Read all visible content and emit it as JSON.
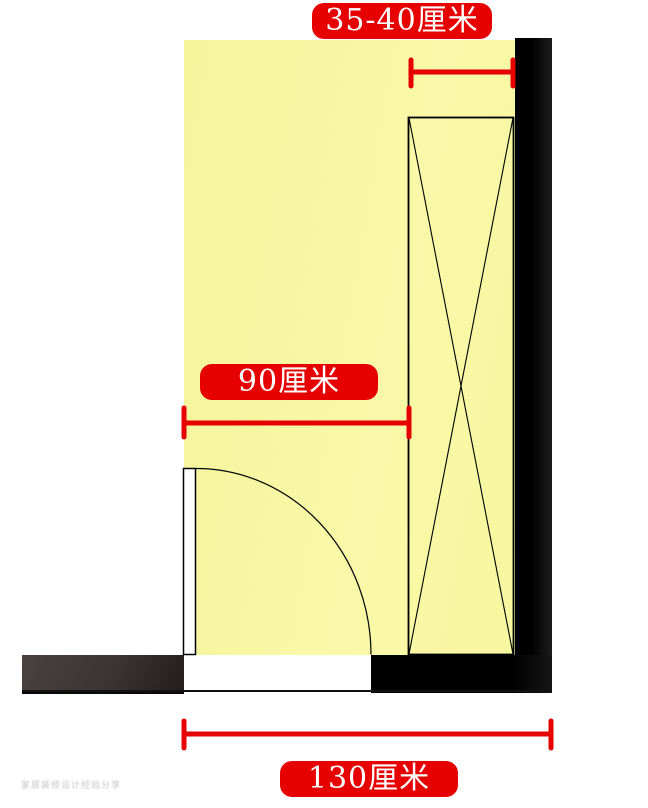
{
  "diagram": {
    "type": "floor-plan",
    "unit": "厘米",
    "dimension_labels": {
      "wardrobe_depth": "35-40厘米",
      "door_to_wardrobe": "90厘米",
      "total_width": "130厘米"
    },
    "dimensions": [
      {
        "id": "wardrobe-depth",
        "value": "35-40",
        "unit": "厘米",
        "measures": "depth of wardrobe along right wall"
      },
      {
        "id": "door-to-wardrobe",
        "value": "90",
        "unit": "厘米",
        "measures": "width from room left edge to wardrobe"
      },
      {
        "id": "total-width",
        "value": "130",
        "unit": "厘米",
        "measures": "overall width including right wall"
      }
    ],
    "elements": {
      "room": "yellow room area",
      "door": "door leaf with quarter-circle swing arc, bottom-left opening",
      "wardrobe": "tall rectangle with X cross along right wall",
      "walls": [
        "right vertical black wall",
        "bottom-right black wall",
        "bottom-left dark wall"
      ]
    },
    "colors": {
      "room_fill": "#f7f7a2",
      "wall_black": "#000000",
      "wall_dark_left": "#3e3636",
      "dimension_red": "#e60000",
      "label_text": "#ffffff",
      "linework": "#000000",
      "background": "#ffffff"
    }
  },
  "watermark": {
    "text": "家居装修设计经验分享"
  }
}
